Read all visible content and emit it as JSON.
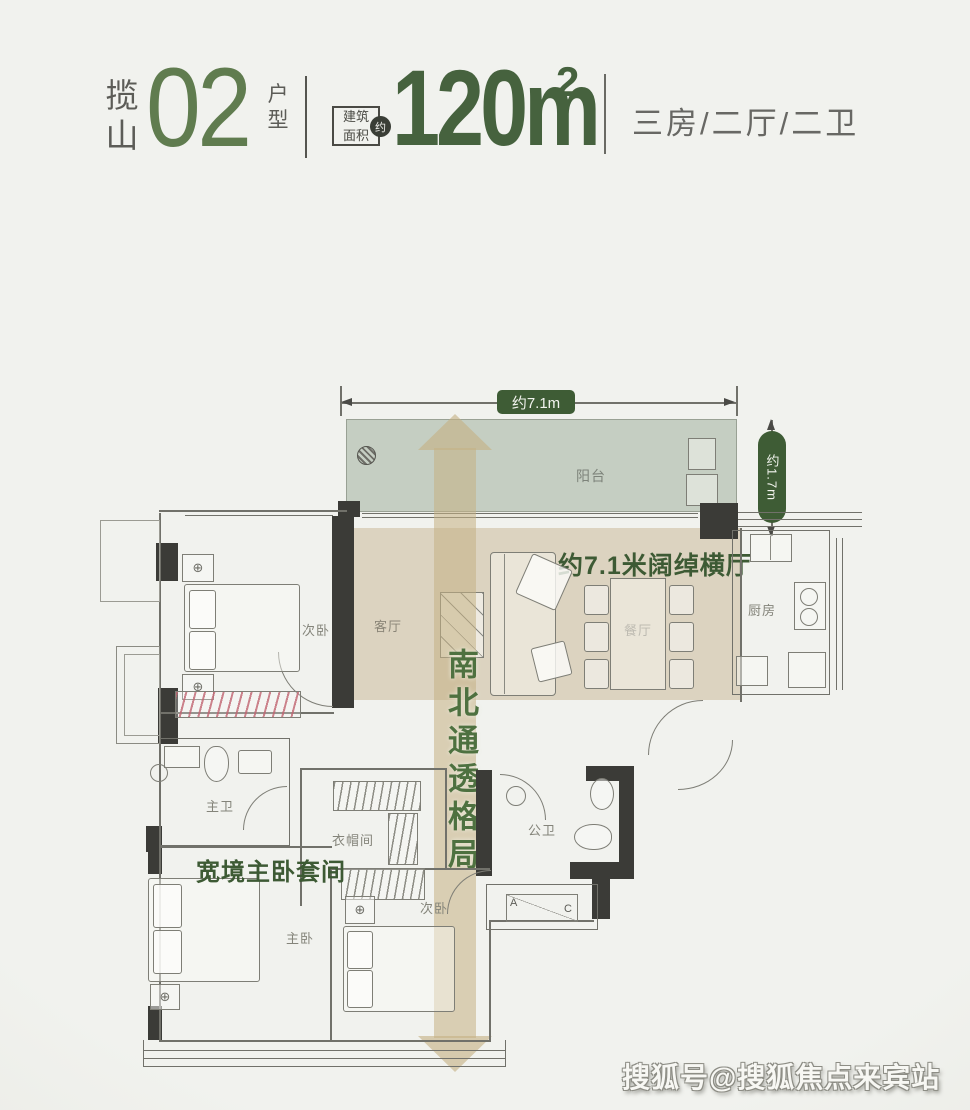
{
  "header": {
    "brand_char1": "揽",
    "brand_char2": "山",
    "unit_number": "02",
    "type_char1": "户",
    "type_char2": "型",
    "area_line1": "建筑",
    "area_line2": "面积",
    "approx_badge": "约",
    "area_value": "120m",
    "area_sup": "2",
    "layout_summary": "三房/二厅/二卫"
  },
  "plan": {
    "dimensions": {
      "top_width": "约7.1m",
      "right_depth": "约1.7m"
    },
    "rooms": {
      "balcony": "阳台",
      "living": "客厅",
      "dining": "餐厅",
      "kitchen": "厨房",
      "bedroom_top": "次卧",
      "bedroom_mid": "次卧",
      "master_bedroom": "主卧",
      "master_bath": "主卫",
      "public_bath": "公卫",
      "cloakroom": "衣帽间"
    },
    "annotations": {
      "wide_hall": "约7.1米阔绰横厅",
      "north_south": "南北通透格局",
      "master_suite": "宽境主卧套间"
    },
    "ac": {
      "a": "A",
      "c": "C"
    }
  },
  "watermark": "搜狐号@搜狐焦点来宾站",
  "colors": {
    "accent_green": "#5f7b4e",
    "dark_green": "#44603c",
    "pill_green": "#3e5c35",
    "band_tan": "#c5b184",
    "balcony_fill": "#c5cec2",
    "hall_fill": "#dcd3c0",
    "wall_dark": "#3b3b37",
    "label_gray": "#84847a"
  }
}
